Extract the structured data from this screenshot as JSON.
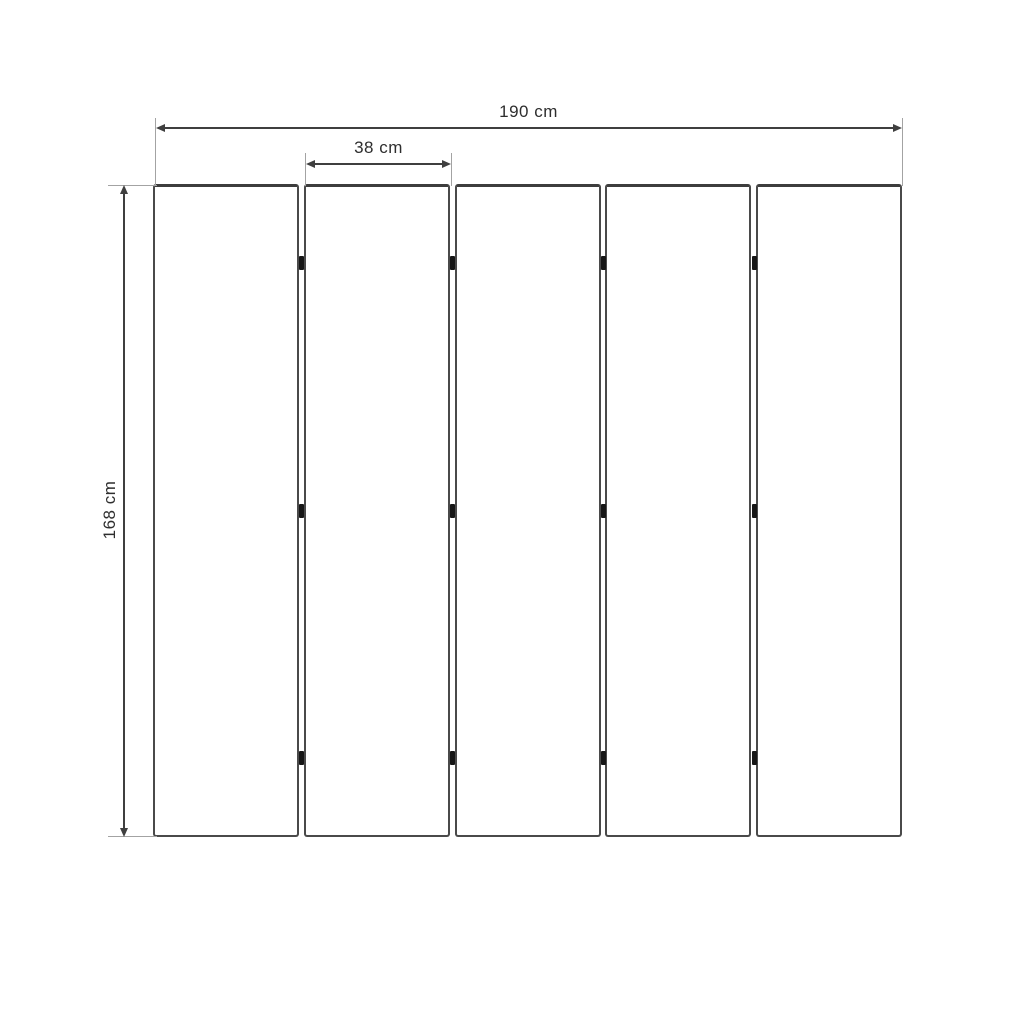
{
  "diagram": {
    "kind": "dimension-drawing",
    "subject": "five-panel folding screen, front view",
    "unit": "cm",
    "labels": {
      "total_width": "190 cm",
      "panel_width": "38 cm",
      "height": "168 cm"
    },
    "values": {
      "total_width_cm": 190,
      "panel_width_cm": 38,
      "height_cm": 168
    },
    "panels": {
      "count": 5,
      "hinge_junctions": 4,
      "hinge_rows_per_junction": 3
    },
    "colors": {
      "background": "#ffffff",
      "dimension_line": "#3f3f3f",
      "extension_line": "#a3a3a3",
      "panel_border": "#4a4a4a",
      "hinge": "#161616",
      "text": "#2e2e2e"
    }
  }
}
